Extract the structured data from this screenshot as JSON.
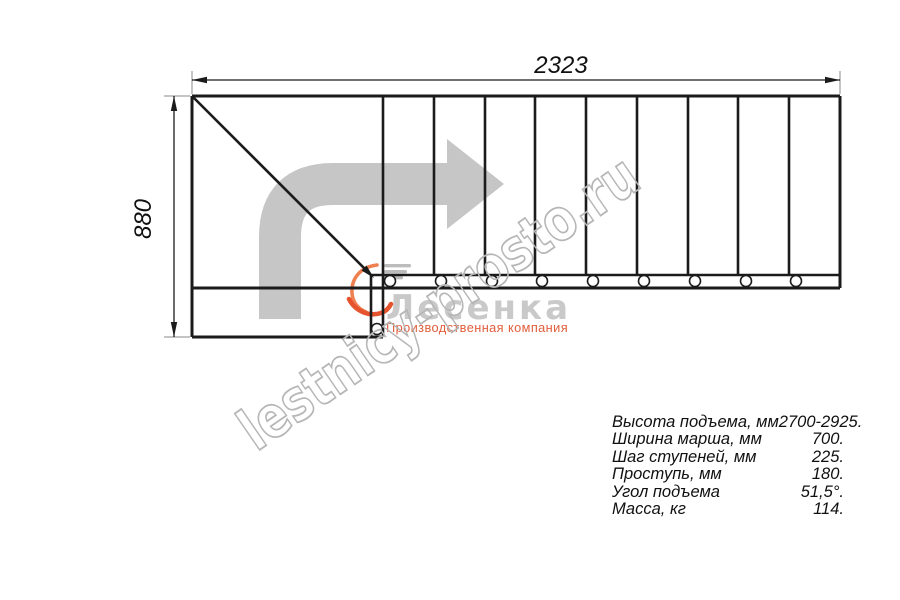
{
  "drawing": {
    "dim_width": "2323",
    "dim_height": "880",
    "steps_visible": 9
  },
  "watermark": {
    "text": "lestnicy-prosto.ru"
  },
  "logo": {
    "brand": "Лесенка",
    "subtitle": "Производственная компания"
  },
  "specs": {
    "rows": [
      {
        "label": "Высота подъема, мм",
        "value": "2700-2925."
      },
      {
        "label": "Ширина марша, мм",
        "value": "700."
      },
      {
        "label": "Шаг ступеней, мм",
        "value": "225."
      },
      {
        "label": "Проступь, мм",
        "value": "180."
      },
      {
        "label": "Угол подъема",
        "value": "51,5°."
      },
      {
        "label": "Масса, кг",
        "value": "114."
      }
    ]
  },
  "colors": {
    "line": "#1b1b1b",
    "direction_arrow_gray": "#c6c6c6",
    "watermark_gray": "#b6b6b6",
    "logo_gray": "#c9c9c9",
    "logo_orange": "#e5532f"
  }
}
